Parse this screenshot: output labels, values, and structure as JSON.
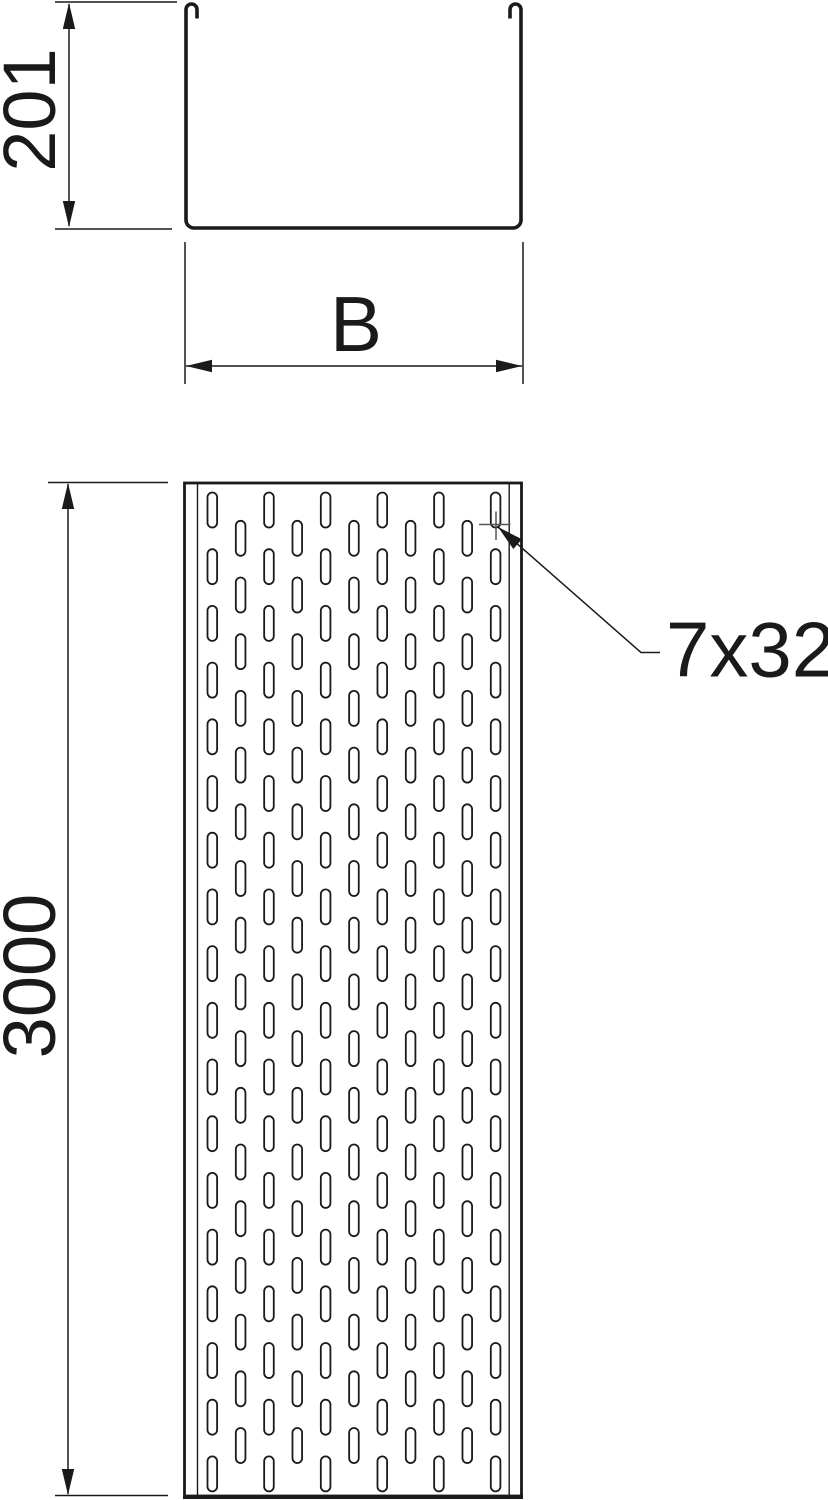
{
  "labels": {
    "height_dim": "201",
    "width_dim": "B",
    "length_dim": "3000",
    "slot_dim": "7x32"
  },
  "colors": {
    "line": "#1a1a1a",
    "marker": "#555555",
    "background": "#ffffff"
  },
  "plan_view": {
    "columns": 11,
    "first_col_x": 212.3,
    "col_pitch": 28.33,
    "row_pitch": 56.7,
    "slot_width": 9.6,
    "slot_height": 35,
    "even_first_y": 492.5,
    "even_count": 18,
    "odd_first_y": 520.8,
    "odd_count": 17
  }
}
